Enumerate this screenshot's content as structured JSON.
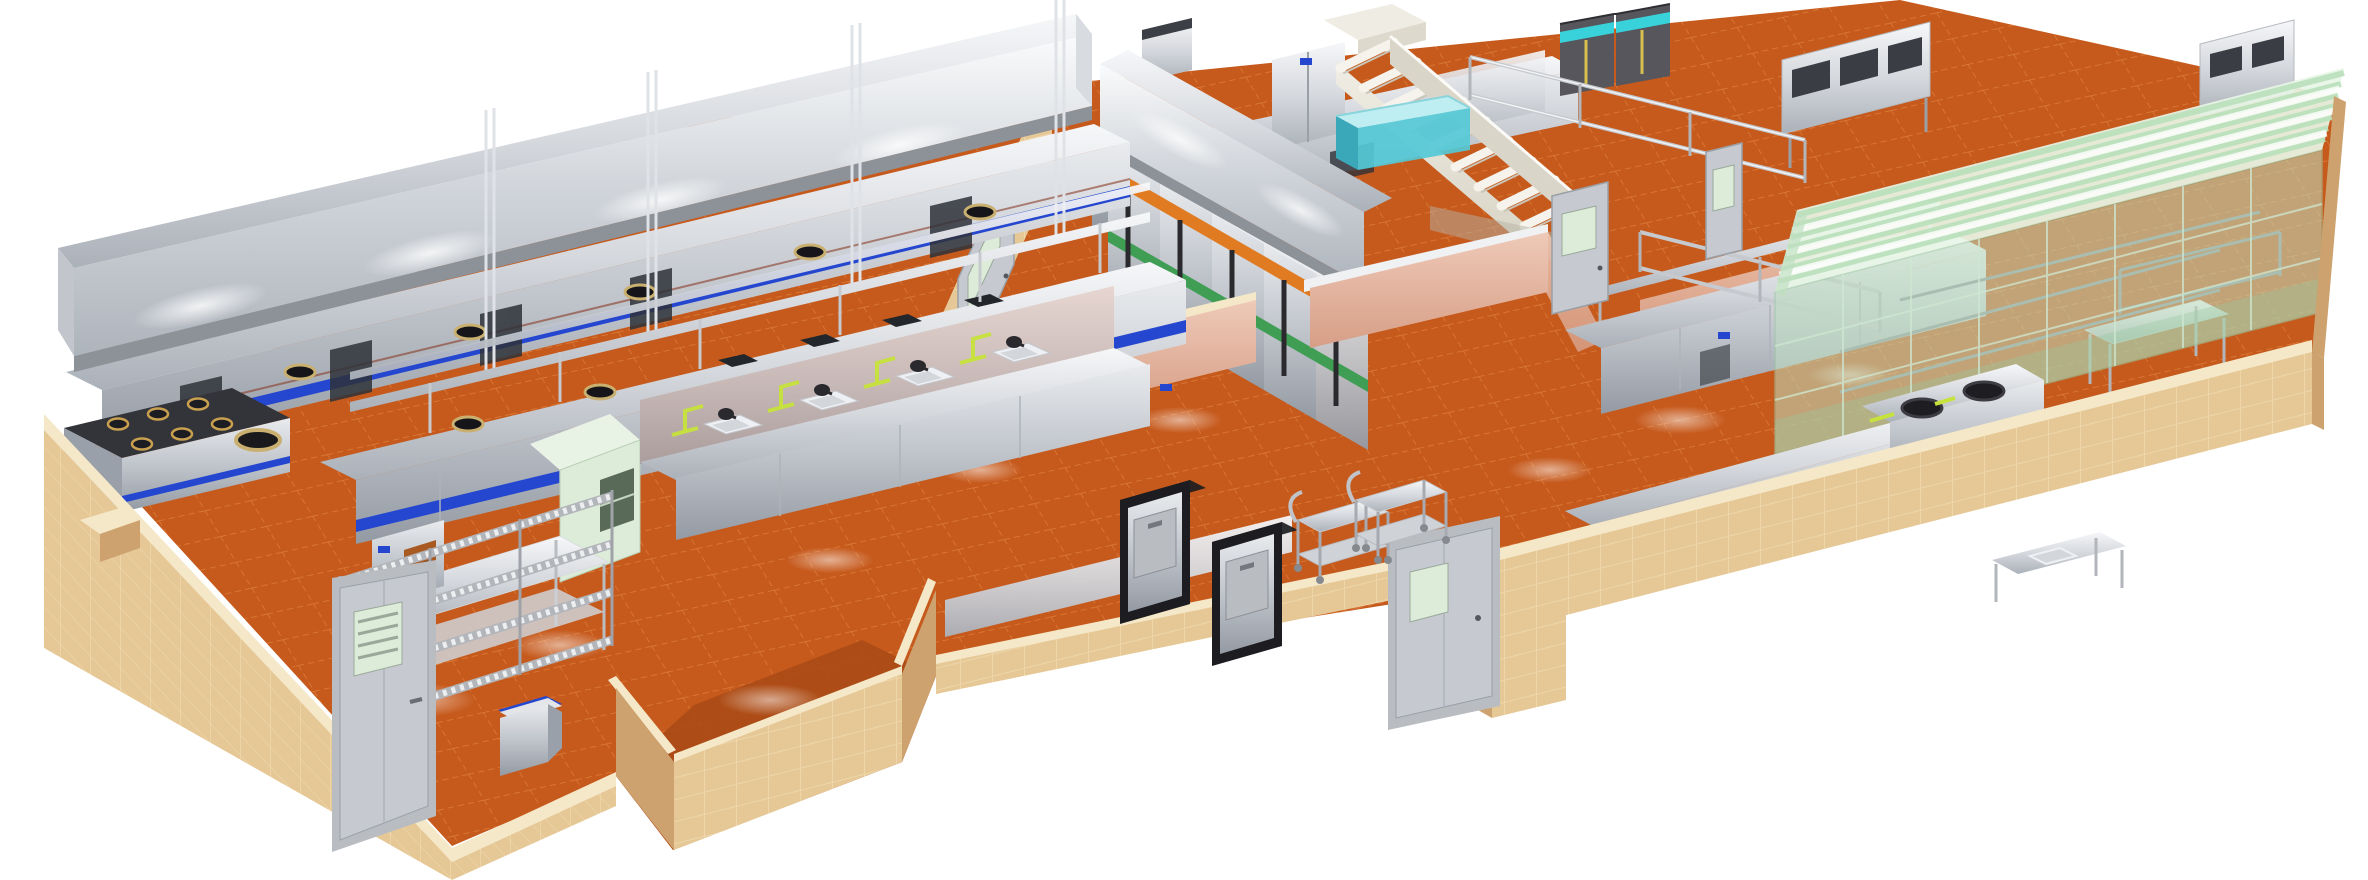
{
  "meta": {
    "title": "3D rendered commercial kitchen floor plan",
    "description": "Isometric cutaway rendering of a large commercial kitchen on a white background: tan ceramic tile perimeter walls, terracotta quarry tile floors, stainless steel cook lines under long exhaust hoods, prep sinks, refrigerator banks, a staircase, dumbwaiter lifts, service trolleys and a glass-enclosed green room at the right end.",
    "view": "axonometric from upper left",
    "background_color": "#ffffff"
  },
  "palette": {
    "background": "#ffffff",
    "floor_tile": "#c65a1d",
    "floor_tile_dark": "#a84a15",
    "floor_grid": "#f09c50",
    "wall_tan": "#e6c897",
    "wall_tan_dark": "#cda26e",
    "wall_cap": "#f5e8c8",
    "wall_grout": "#f2ddb2",
    "stainless_hi": "#f5f6f8",
    "stainless": "#c9cdd3",
    "stainless_low": "#9aa0a9",
    "blue_trim": "#2547cf",
    "teal_water": "#54c9d6",
    "teal_band": "#3ad2da",
    "freezer_dark": "#56565c",
    "band_orange": "#e07b21",
    "band_green": "#3f9e54",
    "pipe_yellow": "#c6e23b",
    "glass_green": "#bfe0c1",
    "glass_stripe": "#e7f5e6",
    "salmon": "#e2a78e",
    "mint": "#dcecd8",
    "stair": "#efece3",
    "door_gray": "#c6cad0",
    "frame_dark": "#1d1d21"
  },
  "regions": [
    {
      "id": "main-cookline",
      "label": "Main cook line along the back-left wall",
      "equipment": [
        "long stainless exhaust canopy hood",
        "wok range with round burners",
        "six-burner gas range",
        "blue-trim cooking suite",
        "chrome hanger rods"
      ]
    },
    {
      "id": "second-line",
      "label": "Parallel island cook line with overshelf",
      "equipment": [
        "open burner hobs",
        "wok rings",
        "two-tier overshelf on posts"
      ]
    },
    {
      "id": "prep-area",
      "label": "Prep area with sink stations",
      "equipment": [
        "4 prep sinks with dark mixer taps",
        "yellow-green supply pipes",
        "work tables with undershelves",
        "undercounter refrigerator with orange vent grille",
        "4-tier wire shelving rack"
      ]
    },
    {
      "id": "cold-storage",
      "label": "Upright refrigerator bank under perpendicular hood",
      "equipment": [
        "5 refrigerator doors with orange and green brand bands",
        "dark vertical handles",
        "two-door stainless upright refrigerator"
      ]
    },
    {
      "id": "freezers",
      "label": "Dark reach-in freezers with cyan trim at back"
    },
    {
      "id": "stairs",
      "label": "White staircase to upper level with side stringers"
    },
    {
      "id": "fish-tank",
      "label": "Teal water holding tank beside the stairs"
    },
    {
      "id": "center-rooms",
      "label": "Center rooms with salmon half-walls, refrigerated counters, wire shelving and pass doors"
    },
    {
      "id": "glass-room",
      "label": "Glass-enclosed green room with striped translucent roof and shelving inside",
      "equipment": [
        "glass curtain walls",
        "interior wire racks",
        "twin stock cookers with black round lids in front"
      ]
    },
    {
      "id": "service",
      "label": "Service corridor notch with dumbwaiter lifts and trolleys",
      "equipment": [
        "2 dumbwaiters with black frames",
        "2 wire service trolleys",
        "blue-top waste pedestal"
      ]
    },
    {
      "id": "doors",
      "label": "Gray steel doors with vision panels",
      "count": 6
    },
    {
      "id": "walls",
      "label": "Tan ceramic tile perimeter walls with light caps"
    },
    {
      "id": "floor",
      "label": "Terracotta quarry tile floor with grid joints and ceiling-light reflections"
    }
  ],
  "object_counts": {
    "exhaust_hoods": 2,
    "wok_rings": 7,
    "gas_burners": 6,
    "sink_stations": 4,
    "refrigerator_bank_doors": 5,
    "dark_freezers": 2,
    "dumbwaiters": 2,
    "trolleys": 2,
    "doors": 6,
    "wire_racks": 3
  }
}
